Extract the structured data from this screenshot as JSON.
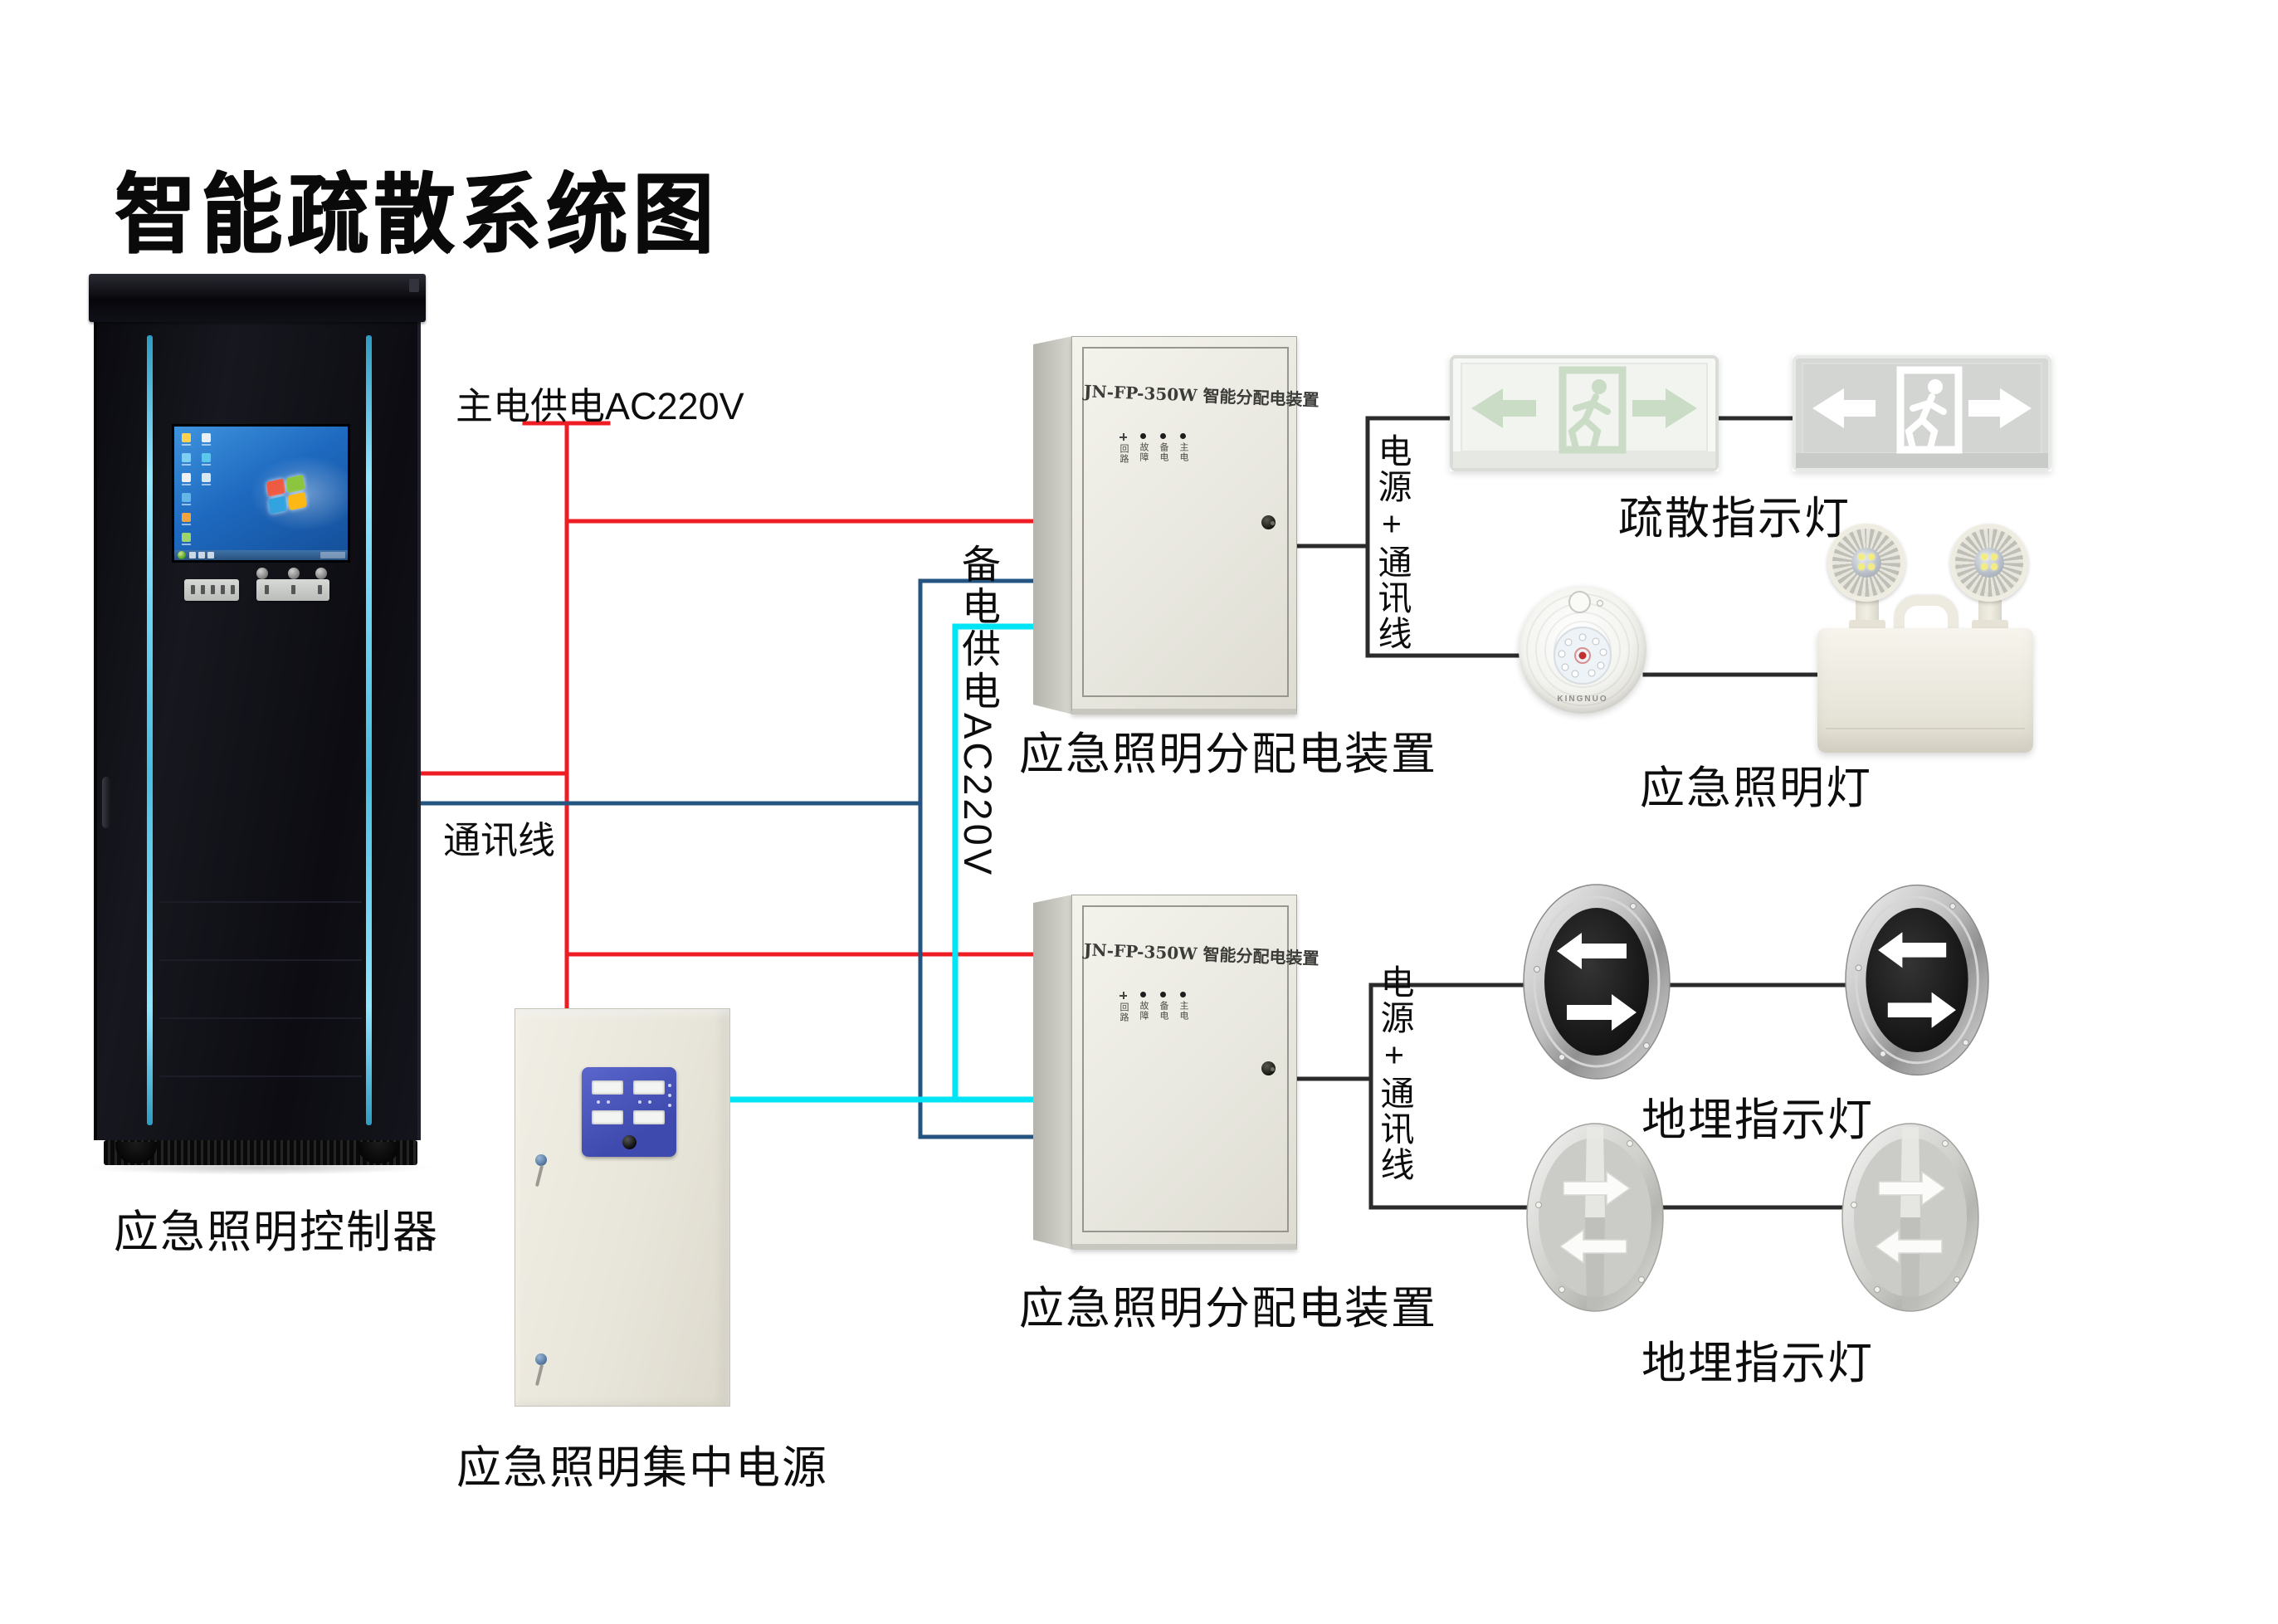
{
  "title": "智能疏散系统图",
  "wires": {
    "colors": {
      "main_power": "#ee1c23",
      "comm": "#24547f",
      "backup_power": "#00e4f6",
      "device_link": "#2b2b2b"
    },
    "labels": {
      "main_power": "主电供电AC220V",
      "comm": "通讯线",
      "backup_power": "备电供电AC220V",
      "power_comm": "电源+通讯线"
    }
  },
  "devices": {
    "controller": {
      "label": "应急照明控制器"
    },
    "central_power": {
      "label": "应急照明集中电源"
    },
    "distribution": {
      "label": "应急照明分配电装置",
      "header": "JN-FP-350W 智能分配电装置",
      "indicators": [
        "回路",
        "故障",
        "备电",
        "主电"
      ]
    },
    "evac_sign": {
      "label": "疏散指示灯"
    },
    "emergency_lamp": {
      "label": "应急照明灯",
      "brand": "KINGNUO"
    },
    "ground_light": {
      "label": "地埋指示灯"
    }
  },
  "colors": {
    "cabinet_accent": "#5bc8e8",
    "screen_desktop": "#1f6ac0",
    "power_panel_blue": "#4a55b8",
    "sign_pictogram_green": "#cbdcc6",
    "sign2_background": "#d5d8d4"
  }
}
